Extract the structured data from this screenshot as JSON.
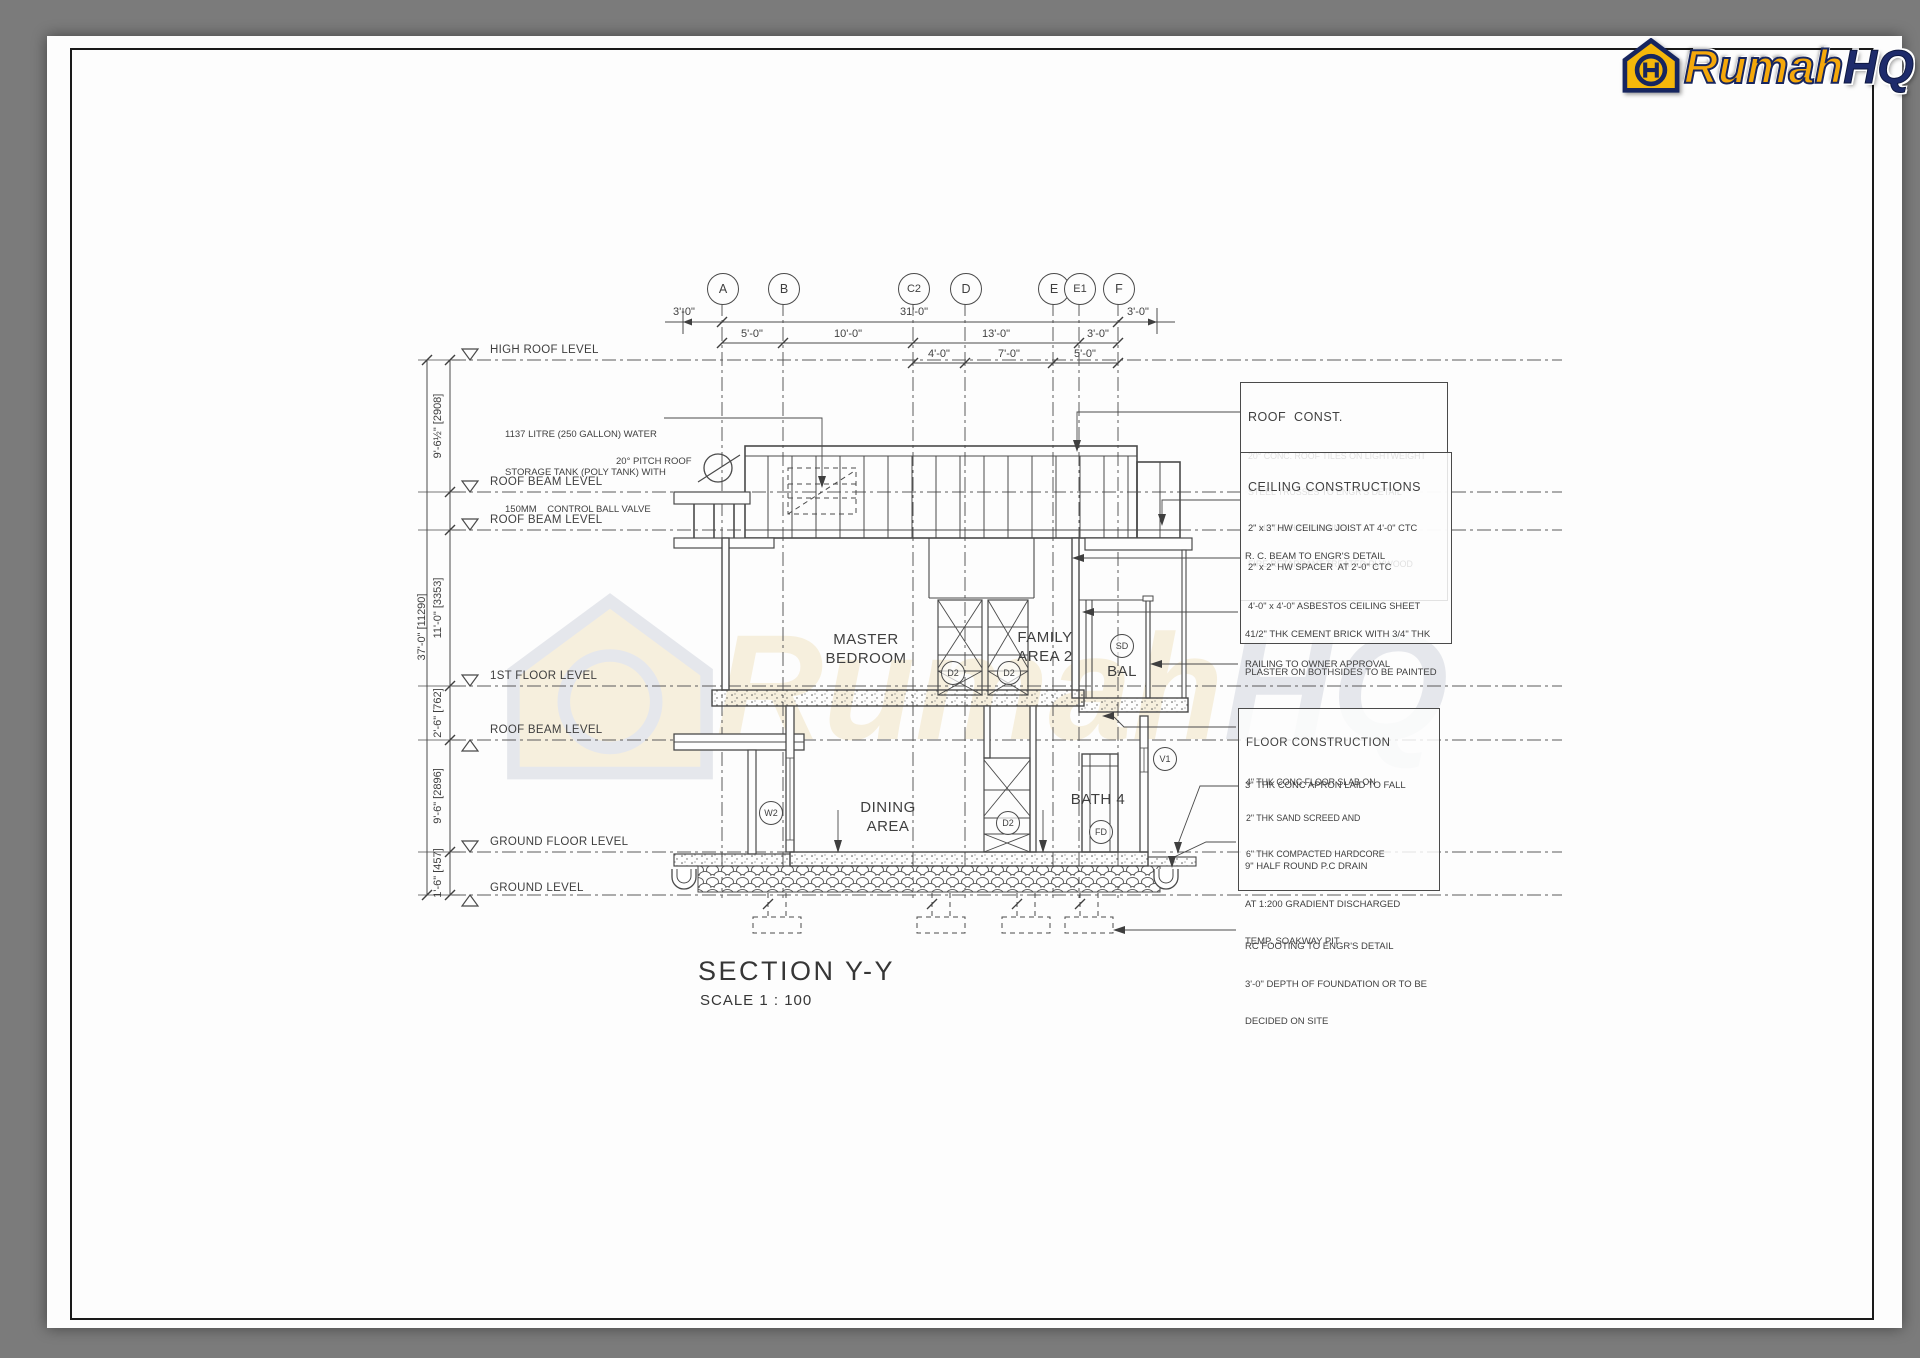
{
  "logo": {
    "icon": "house-icon",
    "word1": "Rumah",
    "word2": "HQ",
    "colors": {
      "gold": "#f5a80a",
      "navy": "#1e2b6b"
    }
  },
  "watermark": {
    "word1": "Rumah",
    "word2": "HQ"
  },
  "title_block": {
    "title": "SECTION Y-Y",
    "scale": "SCALE 1 : 100"
  },
  "grid_bubbles": [
    "A",
    "B",
    "C2",
    "D",
    "E",
    "E1",
    "F"
  ],
  "h_dims": {
    "row1": [
      "3'-0\"",
      "31'-0\"",
      "3'-0\""
    ],
    "row2": [
      "5'-0\"",
      "10'-0\"",
      "13'-0\"",
      "3'-0\""
    ],
    "row3": [
      "4'-0\"",
      "7'-0\"",
      "5'-0\""
    ]
  },
  "v_dims": {
    "total": "37'-0\" [11290]",
    "segments": [
      {
        "label": "9'-6½\" [2908]"
      },
      {
        "label": "11'-0\" [3353]"
      },
      {
        "label": "2'-6\" [762]"
      },
      {
        "label": "9'-6\" [2896]"
      },
      {
        "label": "1'-6\" [457]"
      }
    ]
  },
  "levels": [
    {
      "label": "HIGH ROOF LEVEL"
    },
    {
      "label": "ROOF BEAM LEVEL"
    },
    {
      "label": "ROOF BEAM LEVEL"
    },
    {
      "label": "1ST FLOOR LEVEL"
    },
    {
      "label": "ROOF BEAM LEVEL"
    },
    {
      "label": "GROUND FLOOR LEVEL"
    },
    {
      "label": "GROUND LEVEL"
    }
  ],
  "notes_left": {
    "tank": [
      "1137 LITRE (250 GALLON) WATER",
      "STORAGE TANK (POLY TANK) WITH",
      "150MM    CONTROL BALL VALVE"
    ],
    "pitch": "20° PITCH ROOF"
  },
  "notes_right": {
    "roof_box": {
      "title": "ROOF  CONST.",
      "lines": [
        "20° CONC. ROOF TILES ON LIGHTWEIGHT",
        "STEEL TRUSSES TO ENGR'S DETAIL",
        "2\" METAL HAT-CHANNEL",
        "FIRE RETARDANT TREATED PLYWOOD"
      ]
    },
    "ceiling_box": {
      "title": "CEILING CONSTRUCTIONS",
      "lines": [
        "2\" x 3\" HW CEILING JOIST AT 4'-0\" CTC",
        "2\" x 2\" HW SPACER  AT 2'-0\" CTC",
        "4'-0\" x 4'-0\" ASBESTOS CEILING SHEET"
      ]
    },
    "rc_beam": "R. C. BEAM TO ENGR'S DETAIL",
    "brick": [
      "41/2\" THK CEMENT BRICK WITH 3/4\" THK",
      "PLASTER ON BOTHSIDES TO BE PAINTED"
    ],
    "railing": "RAILING TO OWNER APPROVAL",
    "floor_box": {
      "title": "FLOOR CONSTRUCTION",
      "lines": [
        "4\" THK CONC FLOOR SLAB ON",
        "2\" THK SAND SCREED AND",
        "6\" THK COMPACTED HARDCORE"
      ]
    },
    "apron": "3\" THK CONC APRON LAID TO FALL",
    "drain": [
      "9\" HALF ROUND P.C DRAIN",
      "AT 1:200 GRADIENT DISCHARGED",
      "TEMP. SOAKWAY PIT"
    ],
    "footing": [
      "RC FOOTING TO ENGR'S DETAIL",
      "3'-0\" DEPTH OF FOUNDATION OR TO BE",
      "DECIDED ON SITE"
    ]
  },
  "rooms": [
    {
      "label": "MASTER\nBEDROOM"
    },
    {
      "label": "FAMILY\nAREA 2"
    },
    {
      "label": "BAL"
    },
    {
      "label": "DINING\nAREA"
    },
    {
      "label": "BATH 4"
    }
  ],
  "tags": [
    "D2",
    "D2",
    "SD",
    "W2",
    "D2",
    "FD",
    "V1"
  ],
  "colors": {
    "line": "#4a4a4a",
    "paper": "#fdfdfd",
    "surround": "#7b7b7b"
  }
}
